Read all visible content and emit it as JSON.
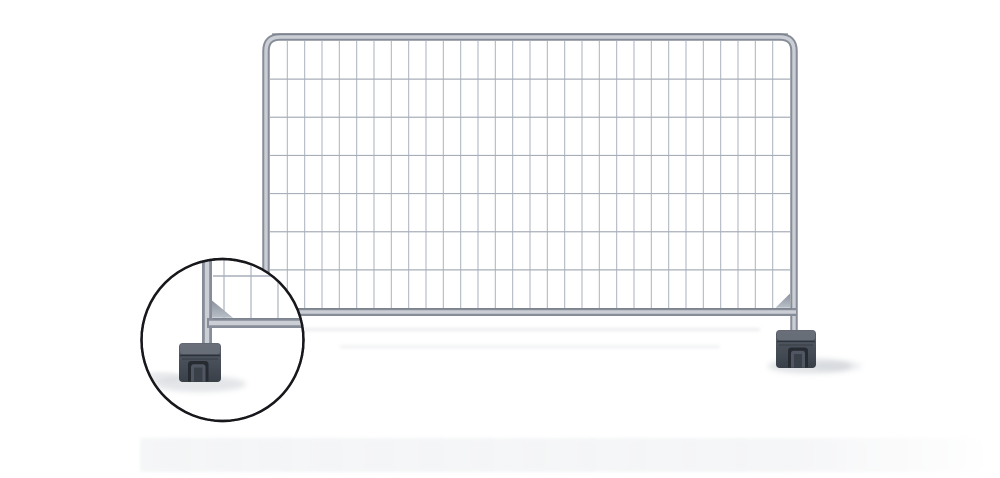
{
  "image": {
    "type": "product-photo",
    "subject": "Temporary construction fence panel with mesh infill, corner gusset plates and block feet",
    "inset_caption": "Magnified circular detail of the fence foot block and corner bracket",
    "background": "#ffffff"
  },
  "colors": {
    "background": "#ffffff",
    "frame_edge": "#878d98",
    "frame_core": "#cbcfd5",
    "frame_hairline": "#6f7580",
    "mesh_wire": "#b2b8c2",
    "mesh_wire_h": "#a9afba",
    "gusset_light": "#b9bfc8",
    "gusset_dark": "#8d939d",
    "foot_top": "#6a707a",
    "foot_body_light": "#5d636d",
    "foot_body": "#49505a",
    "foot_body_dark": "#394048",
    "foot_ridge": "#2e333b",
    "foot_recess": "#262a31",
    "foot_recess_inner": "#515762",
    "shadow_soft": "#c3c7cd",
    "shadow_faint": "#e9ebee",
    "floor_band": "#f3f4f6",
    "inset_border": "#17171c",
    "inset_bg": "#ffffff"
  },
  "fence": {
    "mesh": {
      "cols": 30,
      "rows": 7
    },
    "inset_mesh": {
      "v_lines": [
        224,
        251,
        278,
        303
      ],
      "h_line": 276
    }
  }
}
